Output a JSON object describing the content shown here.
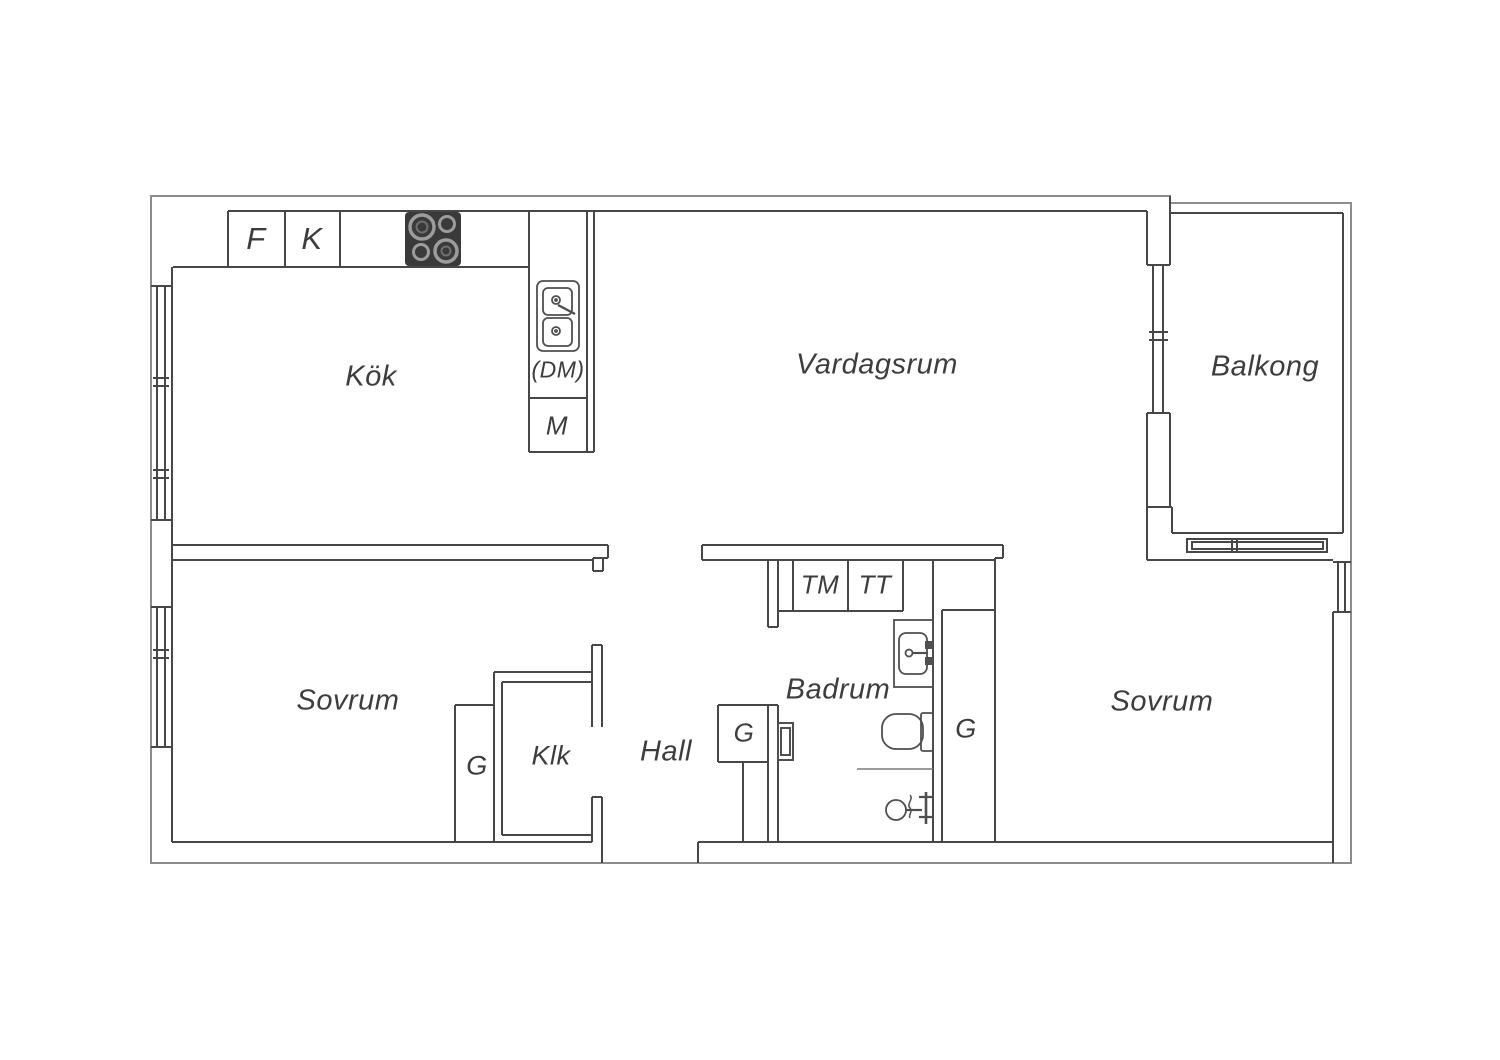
{
  "plan": {
    "type": "apartment-floorplan",
    "language": "sv",
    "rooms": {
      "kitchen": {
        "label": "Kök"
      },
      "living_room": {
        "label": "Vardagsrum"
      },
      "balcony": {
        "label": "Balkong"
      },
      "bedroom_left": {
        "label": "Sovrum"
      },
      "bedroom_right": {
        "label": "Sovrum"
      },
      "bathroom": {
        "label": "Badrum"
      },
      "hall": {
        "label": "Hall"
      },
      "walk_in_closet": {
        "label": "Klk"
      }
    },
    "appliance_labels": {
      "fridge": "F",
      "freezer": "K",
      "dishwasher": "(DM)",
      "m_cabinet": "M",
      "washing_machine": "TM",
      "tumble_dryer": "TT",
      "wardrobe_bedroom": "G",
      "wardrobe_hall": "G",
      "wardrobe_right": "G"
    },
    "fixture_icons": [
      "stove-icon",
      "kitchen-sink-icon",
      "bathroom-sink-icon",
      "toilet-icon",
      "shower-mixer-icon",
      "window-icon",
      "balcony-railing-icon"
    ],
    "colors": {
      "background": "#ffffff",
      "wall_line": "#474747",
      "outer_line": "#8c8c8c",
      "text": "#3d3d3d",
      "stove_fill": "#3a3a3a",
      "burner_ring": "#9c9c9c",
      "partition_line": "#7a7a7a"
    }
  }
}
